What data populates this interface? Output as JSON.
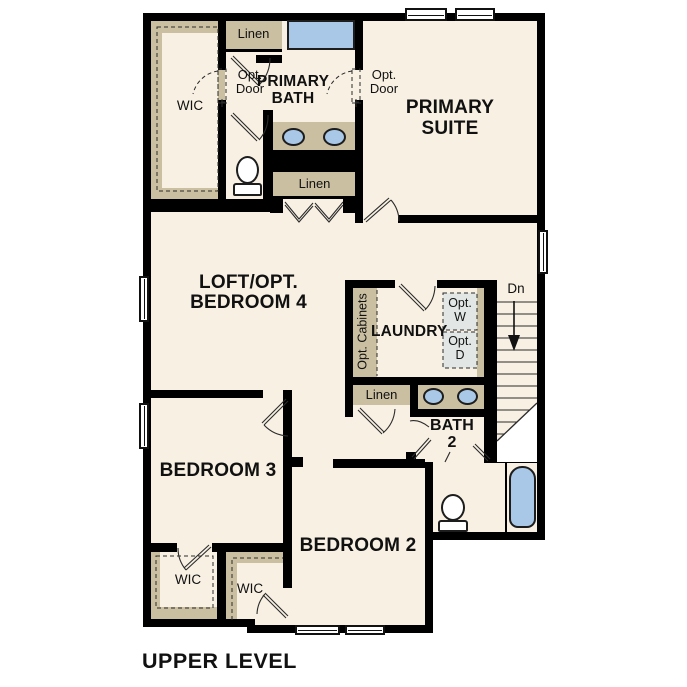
{
  "plan": {
    "title": "UPPER LEVEL",
    "rooms": {
      "primary_suite": "PRIMARY SUITE",
      "primary_bath": "PRIMARY BATH",
      "loft": "LOFT/OPT. BEDROOM 4",
      "laundry": "LAUNDRY",
      "bath2": "BATH 2",
      "bedroom2": "BEDROOM 2",
      "bedroom3": "BEDROOM 3",
      "wic_primary": "WIC",
      "wic_bedroom3": "WIC",
      "wic_bedroom2": "WIC"
    },
    "closets": {
      "linen_top": "Linen",
      "linen_bath": "Linen",
      "linen_hall": "Linen"
    },
    "annotations": {
      "opt_door_left": "Opt. Door",
      "opt_door_right": "Opt. Door",
      "opt_cabinets": "Opt. Cabinets",
      "opt_washer": "Opt. W",
      "opt_dryer": "Opt. D",
      "stairs_down": "Dn"
    },
    "fixtures": {
      "shower": "shower",
      "bathtub": "bathtub",
      "toilet_primary": "toilet",
      "toilet_bath2": "toilet",
      "vanity_primary": "double-sink-vanity",
      "vanity_bath2": "double-sink-vanity",
      "stairs": "staircase-down"
    },
    "colors": {
      "background": "#ffffff",
      "wall": "#000000",
      "floor": "#f7f0e3",
      "cabinetry": "#cbbfa2",
      "fixture_blue": "#a9c8e8",
      "washer_dryer_fill": "#e2e7e6",
      "text": "#111111"
    }
  }
}
